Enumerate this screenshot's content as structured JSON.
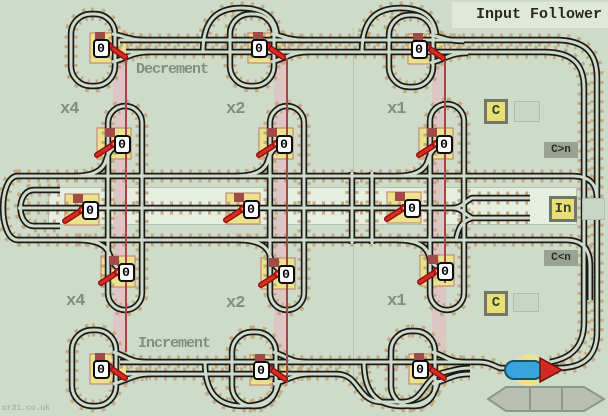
{
  "title": "Input Follower",
  "watermark": "cr31.co.uk",
  "labels": {
    "decrement": "Decrement",
    "increment": "Increment",
    "x4_top": "x4",
    "x2_top": "x2",
    "x1_top": "x1",
    "x4_bottom": "x4",
    "x2_bottom": "x2",
    "x1_bottom": "x1"
  },
  "io": {
    "c_top": "C",
    "c_bottom": "C",
    "input": "In",
    "cmp_greater": "C>n",
    "cmp_less": "C<n"
  },
  "counters": {
    "values": [
      "0",
      "0",
      "0",
      "0",
      "0",
      "0",
      "0",
      "0",
      "0",
      "0",
      "0",
      "0",
      "0",
      "0",
      "0"
    ]
  },
  "train": {
    "direction": "right"
  },
  "colors": {
    "background": "#cedbc8",
    "rail": "#1a1a1a",
    "sleeper": "#c2ab84",
    "switch_pad": "#ebe38c",
    "link_band": "#dcc6c6",
    "link_line": "#a84444",
    "lever_red": "#d92b20",
    "box_yellow": "#e8df76",
    "train_blue": "#38a3dd",
    "arrow_red": "#d42822"
  }
}
